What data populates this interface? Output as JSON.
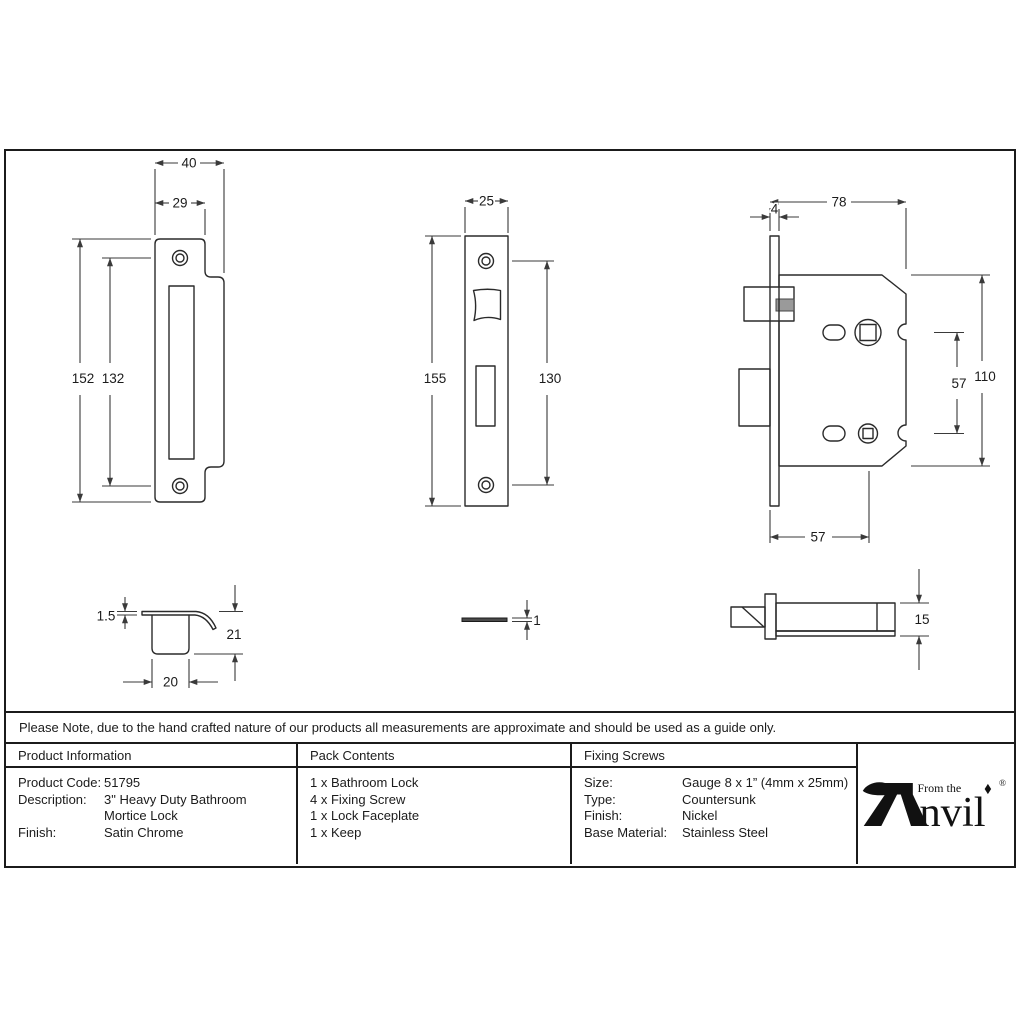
{
  "note": "Please Note, due to the hand crafted nature of our products all measurements are approximate and should be used as a guide only.",
  "table": {
    "product_information": {
      "header": "Product Information",
      "rows": [
        {
          "label": "Product Code:",
          "value": "51795"
        },
        {
          "label": "Description:",
          "value": "3\" Heavy Duty Bathroom"
        },
        {
          "label": "",
          "value": "Mortice Lock"
        },
        {
          "label": "Finish:",
          "value": "Satin Chrome"
        }
      ]
    },
    "pack_contents": {
      "header": "Pack Contents",
      "items": [
        "1 x Bathroom Lock",
        "4 x Fixing Screw",
        "1 x Lock Faceplate",
        "1 x Keep"
      ]
    },
    "fixing_screws": {
      "header": "Fixing Screws",
      "rows": [
        {
          "label": "Size:",
          "value": "Gauge 8 x 1” (4mm x 25mm)"
        },
        {
          "label": "Type:",
          "value": "Countersunk"
        },
        {
          "label": "Finish:",
          "value": "Nickel"
        },
        {
          "label": "Base Material:",
          "value": "Stainless Steel"
        }
      ]
    }
  },
  "logo": {
    "tagline": "From the",
    "brand": "nvil",
    "registered": "®"
  },
  "dims": {
    "keep_front": {
      "overall_width": "40",
      "plate_width": "29",
      "overall_height": "152",
      "inner_height": "132"
    },
    "faceplate_front": {
      "width": "25",
      "height": "155",
      "screw_centres": "130"
    },
    "lock_body": {
      "overall_depth": "78",
      "faceplate_thickness": "4",
      "body_height": "110",
      "follower_centres": "57",
      "backset": "57"
    },
    "keep_profile": {
      "plate_thickness": "1.5",
      "overall_depth": "21",
      "box_width": "20"
    },
    "faceplate_profile": {
      "thickness": "1"
    },
    "lock_profile": {
      "case_thickness": "15"
    }
  },
  "colors": {
    "line": "#2a2a2a",
    "shade": "#9a9a9a",
    "bar": "#4a4a4a"
  }
}
